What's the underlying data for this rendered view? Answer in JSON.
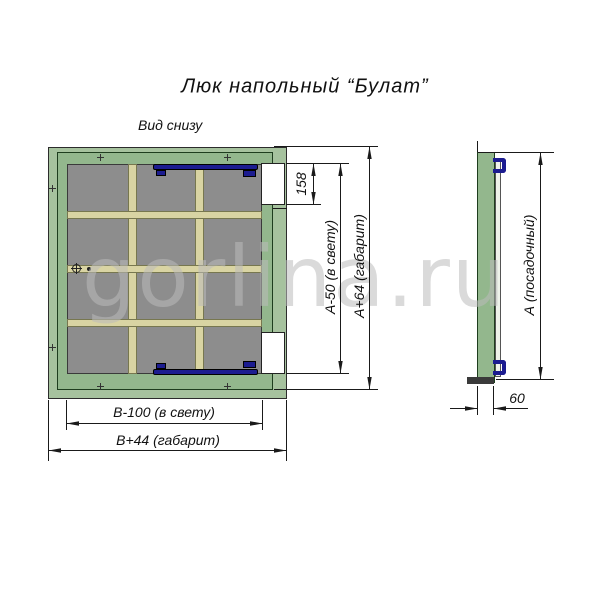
{
  "title": "Люк напольный “Булат”",
  "view_label": "Вид снизу",
  "watermark": "gorlina.ru",
  "dims": {
    "recess": "158",
    "a_clear": "А-50 (в свету)",
    "a_overall": "А+64 (габарит)",
    "b_clear": "В-100 (в свету)",
    "b_overall": "В+44 (габарит)",
    "a_seat": "А (посадочный)",
    "thickness": "60"
  },
  "colors": {
    "frame_green": "#a6c29e",
    "lid_green": "#93b78d",
    "panel_gray": "#8d8d8d",
    "beam_beige": "#d9d4a3",
    "hinge_navy": "#1c1c90",
    "line": "#1a1a1a",
    "watermark_gray": "#bcbcbc"
  }
}
